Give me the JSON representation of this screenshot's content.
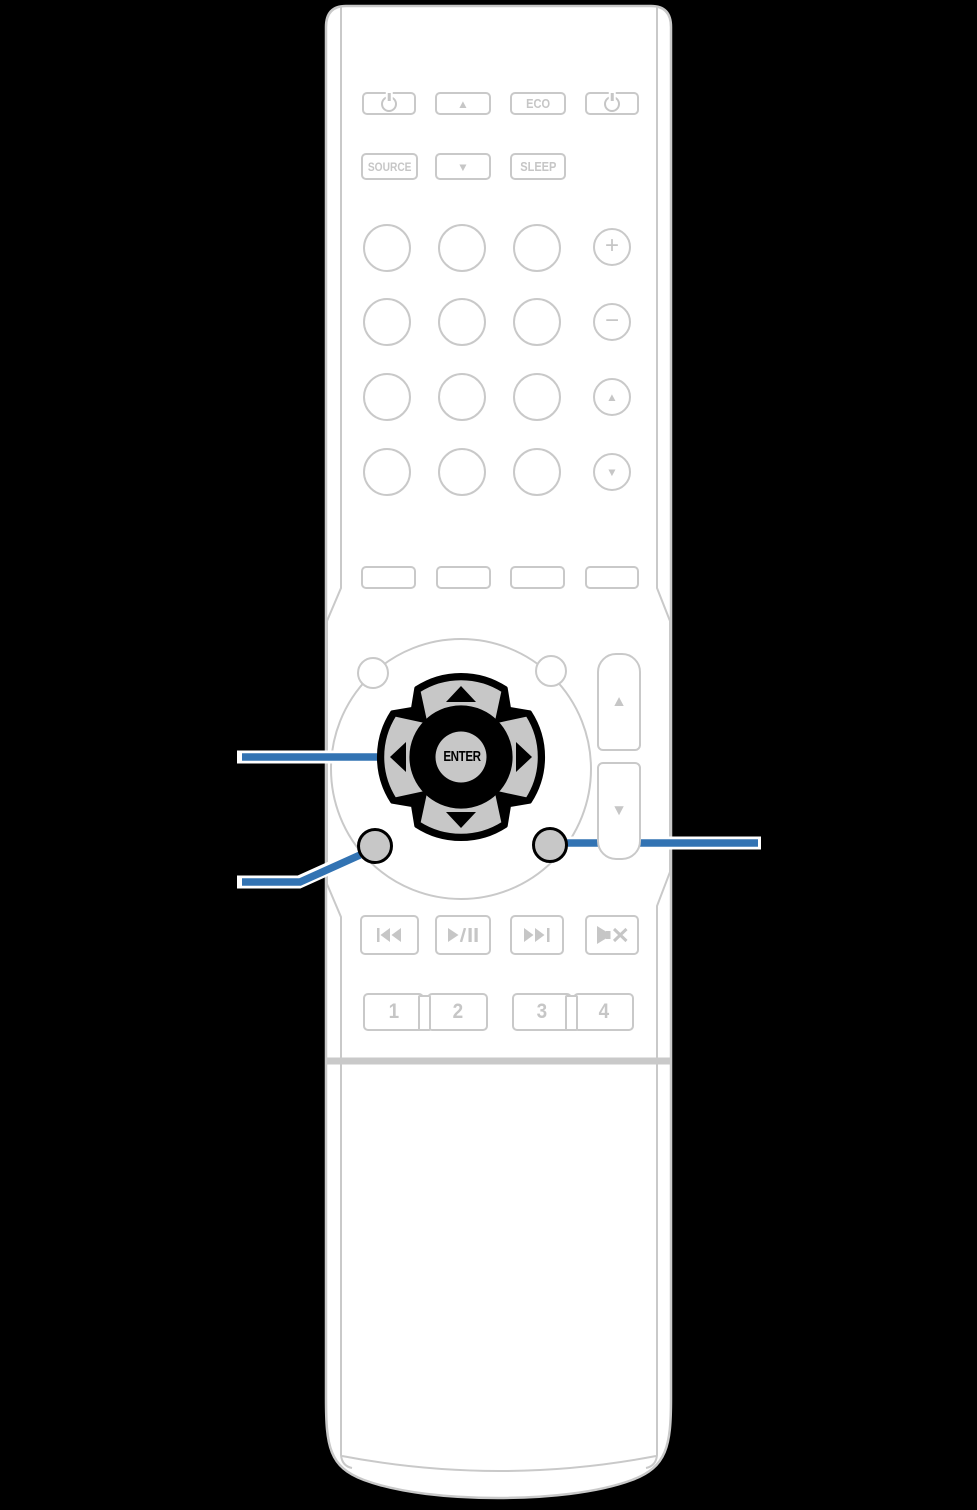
{
  "colors": {
    "background": "#000000",
    "body_outline": "#c9c9c9",
    "label_gray": "#c6c6c6",
    "key_fill_gray": "#c7c7c7",
    "highlight_black": "#000000",
    "callout_blue": "#3273b3"
  },
  "zone2_row": {
    "group_label": "ZONE 2",
    "power_label": "POWER",
    "eco_button": "ECO",
    "up_icon": "▲"
  },
  "volume_row": {
    "volume_label": "VOLUME",
    "source_button": "SOURCE",
    "sleep_button": "SLEEP",
    "down_icon": "▼"
  },
  "inputs": {
    "cbl_sat": "CBL/SAT",
    "dvd_line1": "DVD/",
    "dvd_line2": "Blu-ray",
    "bluray": "Blu-ray",
    "game": "GAME",
    "aux": "AUX",
    "media_line1": "MEDIA",
    "media_line2": "PLAYER",
    "ipod_usb": "iPod/USB",
    "tv_audio": "TV AUDIO",
    "tuner": "TUNER",
    "online_line1": "ONLINE",
    "online_line2": "MUSIC",
    "bluetooth": "Bluetooth",
    "internet_line1": "INTERNET",
    "internet_line2": "RADIO"
  },
  "right_column": {
    "channel_label": "CHANNEL",
    "channel_plus": "+",
    "channel_minus": "−",
    "page_label": "PAGE",
    "page_up_icon": "▲",
    "page_down_icon": "▼"
  },
  "sound_mode": {
    "group_label": "SOUND MODE",
    "movie": "MOVIE",
    "music": "MUSIC",
    "game": "GAME",
    "pure": "PURE"
  },
  "cursor_section": {
    "info_label": "INFO",
    "option_label": "OPTION",
    "enter_label": "ENTER",
    "volume_label": "VOLUME",
    "volume_up_icon": "▲",
    "volume_down_icon": "▼",
    "back_label": "BACK",
    "setup_label": "SETUP"
  },
  "transport": {
    "tune_minus_label": "TUNE —",
    "tune_plus_label": "TUNE +",
    "mute_label": "MUTE"
  },
  "quick_select": {
    "group_label": "QUICK SELECT",
    "buttons": [
      "1",
      "2",
      "3",
      "4"
    ]
  }
}
